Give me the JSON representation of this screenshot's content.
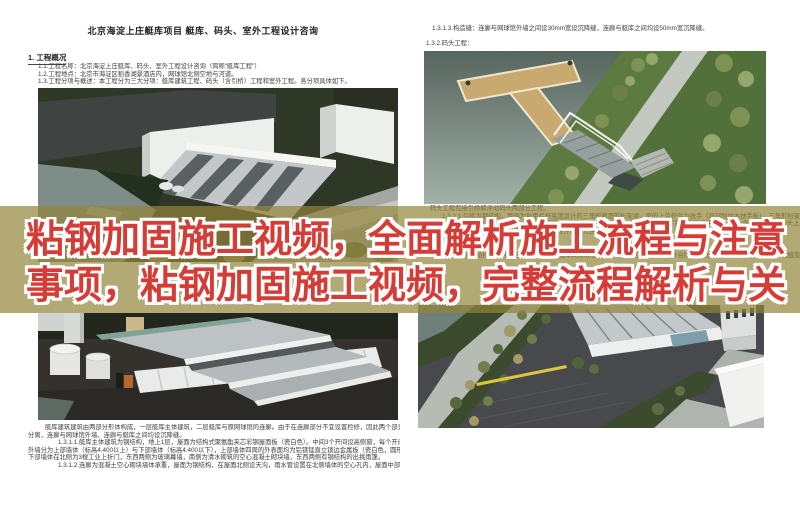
{
  "banner": {
    "line1": "粘钢加固施工视频，全面解析施工流程与注意",
    "line2": "事项，粘钢加固施工视频，完整流程解析与关",
    "text_color": "#d63c36",
    "outline_color": "#ffffff",
    "overlay_color": "rgba(147,132,58,0.70)"
  },
  "left_page": {
    "title": "北京海淀上庄艇库项目 艇库、码头、室外工程设计咨询",
    "section_heading": "1.  工程概况",
    "intro_lines": [
      "1.1.工程名称：北京海淀上庄艇库、码头、室外工程设计咨询（简称“艇库工程”）",
      "1.2.工程地点：北京市海淀区稻香湖景酒店内，网球馆北侧空地与河道。",
      "1.3.工程分项与概述：本工程分为三大分项：艇库建筑工程、码头（含引桥）工程和室外工程。各分项具体如下。"
    ],
    "render1_caption": "1.3.1.艇库建筑工程：",
    "bottom_paragraph": [
      "艇库建筑建筑由两部分形体构成，一层艇库主体建筑，二层艇库与原网球馆的连廊。由于在连廊部分不宜设置检修，因此两个部分的基础、结构",
      "分离，连廊与网球馆外墙、连廊与艇库之间均设沉降缝。",
      "1.3.1.1.艇库主体建筑为钢结构，地上1层，屋面为结构式聚氨酯夹芯彩钢屋面板（瓷白色）。中间3个开间设高侧窗，每个开间均设排水天沟，",
      "外墙分为上部墙体（标高4.400以上）与下部墙体（标高4.400以下），上部墙体四周的外表面均为铝镁锰直立锁边金属板（瓷白色，圆形360锁边），",
      "下部墙体在北侧为3樘工业上折门，东西两侧为玻璃幕墙，南侧为清水砌筑的空心混凝土砌块墙，东西两侧有钢结构的出挑雨篷。",
      "1.3.1.2.连廊为混凝土空心砌块墙体承重，屋面为钢结构，在屋面北侧设天沟，雨水管设置在北侧墙体的空心孔内，屋面中部设采光天窗。"
    ]
  },
  "right_page": {
    "top_lines": [
      "1.3.1.3.构造缝：连廊与网球馆外墙之间设30mm宽设沉降缝，连廊与艇库之间均设50mm宽沉降缝。",
      "1.3.2.码头工程："
    ],
    "mid_lines": [
      "码头工程包括引桥和浮动码头两部分工程。",
      "1.3.2.1.引桥为钢结构，两侧为利用栏杆高度设计的三角形截面的桁架梁，梁的上弦杆件为扶手（局部附加木扶手板）。三角形桁架梁之间",
      "间距相等，桥面上为了方便排水，铺设玻璃钢防滑桥面板，引桥在河道一侧与固定在驳岸顶部的预埋件铰接，另一端支承在浮动码头上。",
      "1.3.2.2.浮动码头为装配式结构，由若干标准浮箱单元拼装而成。",
      "1.3.3.室外工程：",
      "室外工程包括：给排水及强弱电的外线工程，艇库四周场地的铺装工程（包括其中的室外台阶）、码头引桥至道路的台阶工程，栽植及移栽树木"
    ]
  },
  "renders": {
    "render1_name": "aerial view of boathouse site",
    "render2_name": "boathouse close-up with tanks",
    "render3_name": "floating dock and truss footbridge",
    "render4_name": "site aerial with parking lot"
  },
  "colors": {
    "doc_text": "#3c3c3c",
    "water": "#7e8d88",
    "grass": "#5d7a40",
    "dock_tan": "#c8aa70",
    "asphalt": "#47494c",
    "yellow_marking": "#dcc63e"
  }
}
